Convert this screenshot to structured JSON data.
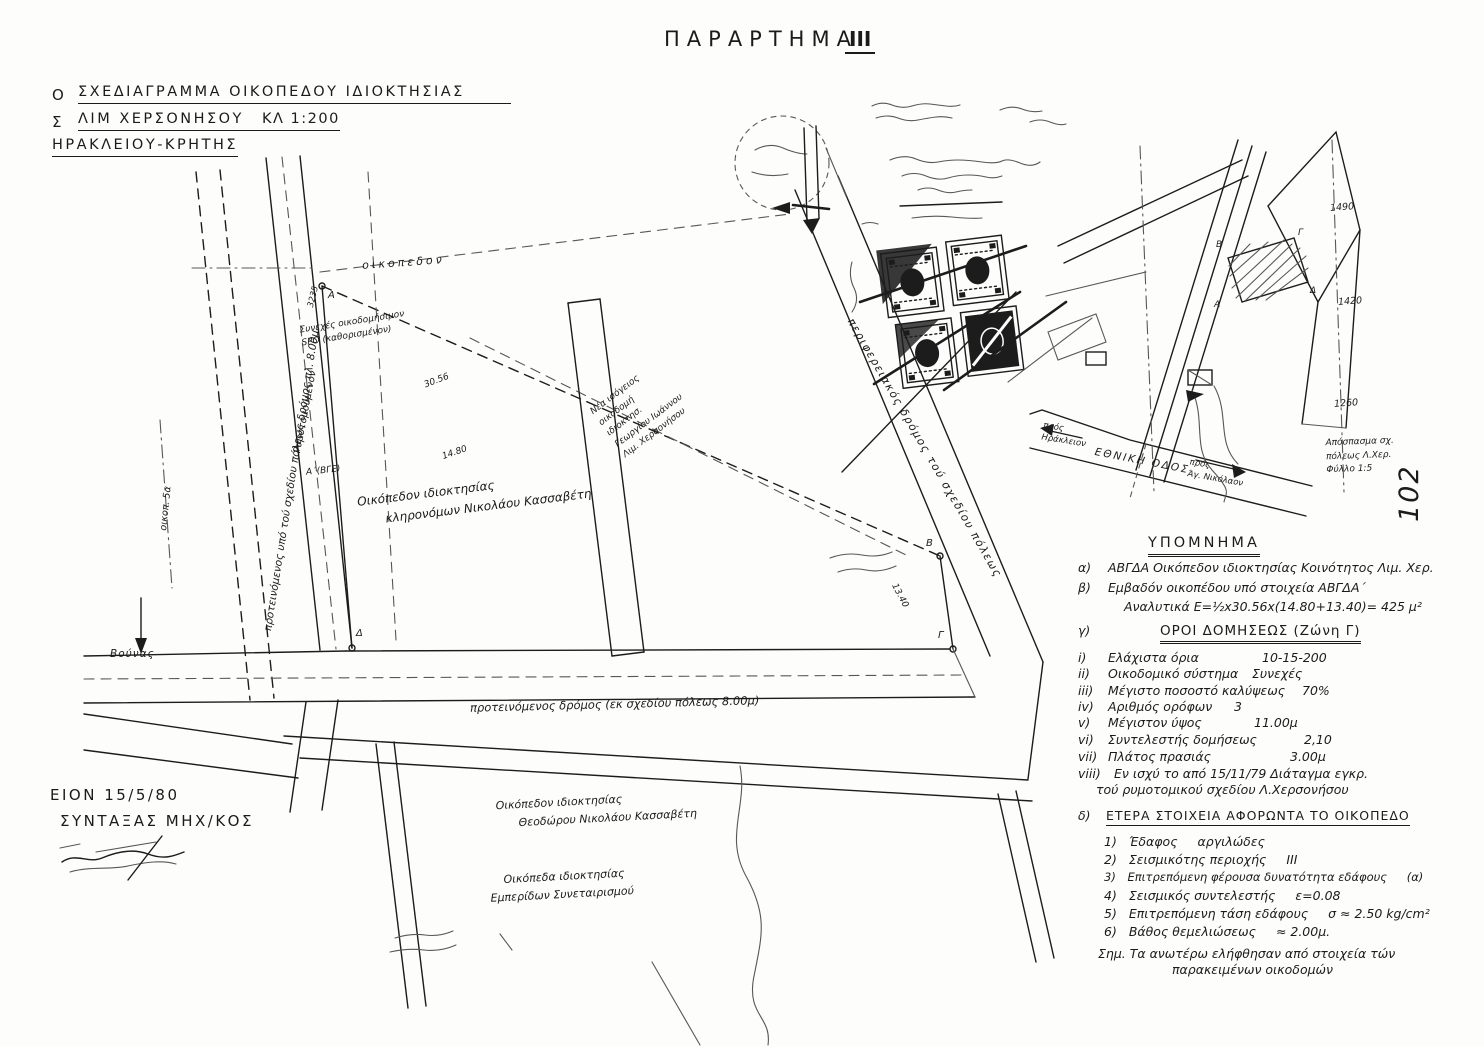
{
  "document": {
    "header_title": "ΠΑΡΑΡΤΗΜΑ",
    "header_number": "III",
    "page_number": "102"
  },
  "title_block": {
    "edge1": "Ο",
    "line1": "ΣΧΕΔΙΑΓΡΑΜΜΑ ΟΙΚΟΠΕΔΟΥ ΙΔΙΟΚΤΗΣΙΑΣ",
    "edge2": "Σ",
    "line2": "ΛΙΜ ΧΕΡΣΟΝΗΣΟΥ",
    "scale": "ΚΛ 1:200",
    "line3": "ΗΡΑΚΛΕΙΟΥ-ΚΡΗΤΗΣ"
  },
  "plan_labels": {
    "oikopedon": "οικοπεδον",
    "rymotomoumenon": "Ρυμοτομούμενον",
    "left_road": "προτεινόμενος υπό τού σχεδίου πόλεως δρόμος πλ. 8.00μ",
    "oikop_5a": "οικοπ. 5α",
    "spo_l1": "Συνεχές οικοδομήσιμον",
    "spo_l2": "SPO (καθορισμένον)",
    "corner_note": "Α΄(ΒΓΕ)",
    "parcel_no": "3235",
    "dim_top": "30.56",
    "dim_left": "14.80",
    "dim_right": "13.40",
    "nb_l1": "Νέα ισόγειος",
    "nb_l2": "οικοδομή",
    "nb_l3": "ιδιοκτησ.",
    "nb_l4": "Γεωργίου Ιωάννου",
    "nb_l5": "Λιμ. Χερσονήσου",
    "main_plot_l1": "Οικόπεδον ιδιοκτησίας",
    "main_plot_l2": "κληρονόμων Νικολάου Κασσαβέτη",
    "corner_a": "Α",
    "corner_b": "Β",
    "corner_g": "Γ",
    "corner_d": "Δ",
    "bottom_road": "προτεινόμενος δρόμος (εκ σχεδίου πόλεως 8.00μ)",
    "diagonal_road": "περιφερειακός δρόμος τού σχεδίου πόλεως",
    "south1_l1": "Οικόπεδον ιδιοκτησίας",
    "south1_l2": "Θεοδώρου Νικολάου Κασσαβέτη",
    "south2_l1": "Οικόπεδα ιδιοκτησίας",
    "south2_l2": "Εμπερίδων Συνεταιρισμού",
    "bounas": "Βούνας"
  },
  "minimap": {
    "road_label": "ΕΘΝΙΚΗ ΟΔΟΣ",
    "to_left_l1": "πρός",
    "to_left_l2": "Ηράκλειον",
    "to_right_l1": "πρός",
    "to_right_l2": "Άγ. Νικόλαον",
    "grid_1": "1490",
    "grid_2": "1420",
    "grid_3": "1260",
    "corner_a": "Α",
    "corner_b": "Β",
    "corner_g": "Γ",
    "corner_d": "Δ",
    "extract_l1": "Απόσπασμα σχ.",
    "extract_l2": "πόλεως Λ.Χερ.",
    "extract_l3": "Φύλλο 1:5"
  },
  "legend": {
    "title": "ΥΠΟΜΝΗΜΑ",
    "a_n": "α)",
    "a_text": "ΑΒΓΔΑ Οικόπεδον ιδιοκτησίας Κοινότητος Λιμ. Χερ.",
    "b_n": "β)",
    "b_text": "Εμβαδόν οικοπέδου υπό στοιχεία ΑΒΓΔΑ΄",
    "b_text2": "Αναλυτικά Ε=½x30.56x(14.80+13.40)= 425 μ²",
    "c_n": "γ)",
    "c_title": "ΟΡΟΙ ΔΟΜΗΣΕΩΣ (Ζώνη Γ)",
    "items": [
      {
        "n": "i)",
        "l": "Ελάχιστα όρια",
        "v": "10-15-200"
      },
      {
        "n": "ii)",
        "l": "Οικοδομικό σύστημα",
        "v": "Συνεχές"
      },
      {
        "n": "iii)",
        "l": "Μέγιστο ποσοστό καλύψεως",
        "v": "70%"
      },
      {
        "n": "iv)",
        "l": "Αριθμός ορόφων",
        "v": "3"
      },
      {
        "n": "v)",
        "l": "Μέγιστον ύψος",
        "v": "11.00μ"
      },
      {
        "n": "vi)",
        "l": "Συντελεστής δομήσεως",
        "v": "2,10"
      },
      {
        "n": "vii)",
        "l": "Πλάτος πρασιάς",
        "v": "3.00μ"
      }
    ],
    "viii_n": "viii)",
    "viii_l1": "Εν ισχύ το από 15/11/79 Διάταγμα εγκρ.",
    "viii_l2": "τού ρυμοτομικού σχεδίου Λ.Χερσονήσου",
    "d_n": "δ)",
    "d_title": "ΕΤΕΡΑ ΣΤΟΙΧΕΙΑ ΑΦΟΡΩΝΤΑ ΤΟ ΟΙΚΟΠΕΔΟ",
    "d_items": [
      {
        "n": "1)",
        "l": "Έδαφος",
        "v": "αργιλώδες"
      },
      {
        "n": "2)",
        "l": "Σεισμικότης περιοχής",
        "v": "III"
      },
      {
        "n": "3)",
        "l": "Επιτρεπόμενη φέρουσα δυνατότητα εδάφους",
        "v": "(α)"
      },
      {
        "n": "4)",
        "l": "Σεισμικός συντελεστής",
        "v": "ε=0.08"
      },
      {
        "n": "5)",
        "l": "Επιτρεπόμενη τάση εδάφους",
        "v": "σ ≈ 2.50 kg/cm²"
      },
      {
        "n": "6)",
        "l": "Βάθος θεμελιώσεως",
        "v": "≈ 2.00μ."
      }
    ],
    "note_l1": "Σημ. Τα ανωτέρω ελήφθησαν από στοιχεία τών",
    "note_l2": "παρακειμένων οικοδομών"
  },
  "footer": {
    "place_date": "ΕΙΟΝ 15/5/80",
    "author": "ΣΥΝΤΑΞΑΣ ΜΗΧ/ΚΟΣ"
  }
}
